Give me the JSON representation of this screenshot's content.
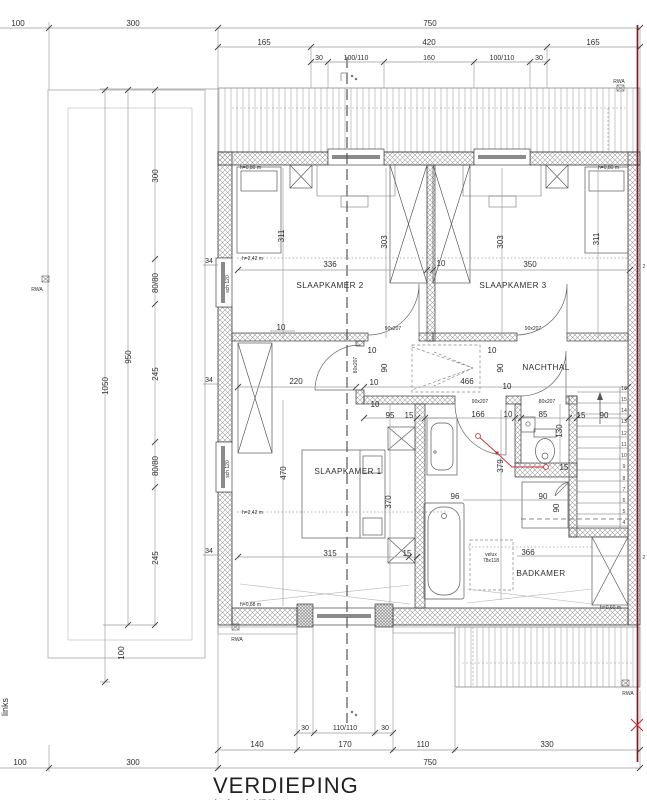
{
  "meta": {
    "title": "VERDIEPING",
    "subtitle_partial": "(schaal 1/50)",
    "side_label": "links",
    "edge_mark": "2"
  },
  "rooms": {
    "sk1": "SLAAPKAMER 1",
    "sk2": "SLAAPKAMER 2",
    "sk3": "SLAAPKAMER 3",
    "nachthal": "NACHTHAL",
    "badkamer": "BADKAMER"
  },
  "top": {
    "r1": [
      "100",
      "300",
      "750"
    ],
    "r2": [
      "165",
      "420",
      "165"
    ],
    "r3": [
      "30",
      "100/110",
      "160",
      "100/110",
      "30"
    ]
  },
  "left": {
    "col": [
      "300",
      "80/80",
      "245"
    ],
    "d950": "950",
    "d1050": "1050",
    "d100": "100",
    "w34": "34"
  },
  "bottom": {
    "w110110": "110/110",
    "r2": [
      "140",
      "170",
      "110",
      "330"
    ]
  },
  "plan": {
    "d336": "336",
    "d10": "10",
    "d350": "350",
    "d311": "311",
    "d303": "303",
    "d220": "220",
    "d466": "466",
    "d90": "90",
    "d95": "95",
    "d15": "15",
    "d166": "166",
    "d85": "85",
    "d130": "130",
    "d379": "379",
    "d96": "96",
    "d470": "470",
    "d370": "370",
    "d315": "315",
    "d366": "366",
    "door90": "90x207",
    "door80": "80x207",
    "sch": "sch 120",
    "h242": "h=2,42 m",
    "h080": "h=0,80 m",
    "h088": "h=0,88 m",
    "h060": "h=0,60 m",
    "velux1": "velux",
    "velux2": "78x118",
    "rwa": "RWA"
  },
  "stairs": [
    "16",
    "15",
    "14",
    "13",
    "12",
    "11",
    "10",
    "9",
    "8",
    "7",
    "6",
    "5",
    "4"
  ],
  "colors": {
    "section_line": "#7a1c1c",
    "accent_red": "#c03038",
    "hatch": "#b9b9b9"
  }
}
